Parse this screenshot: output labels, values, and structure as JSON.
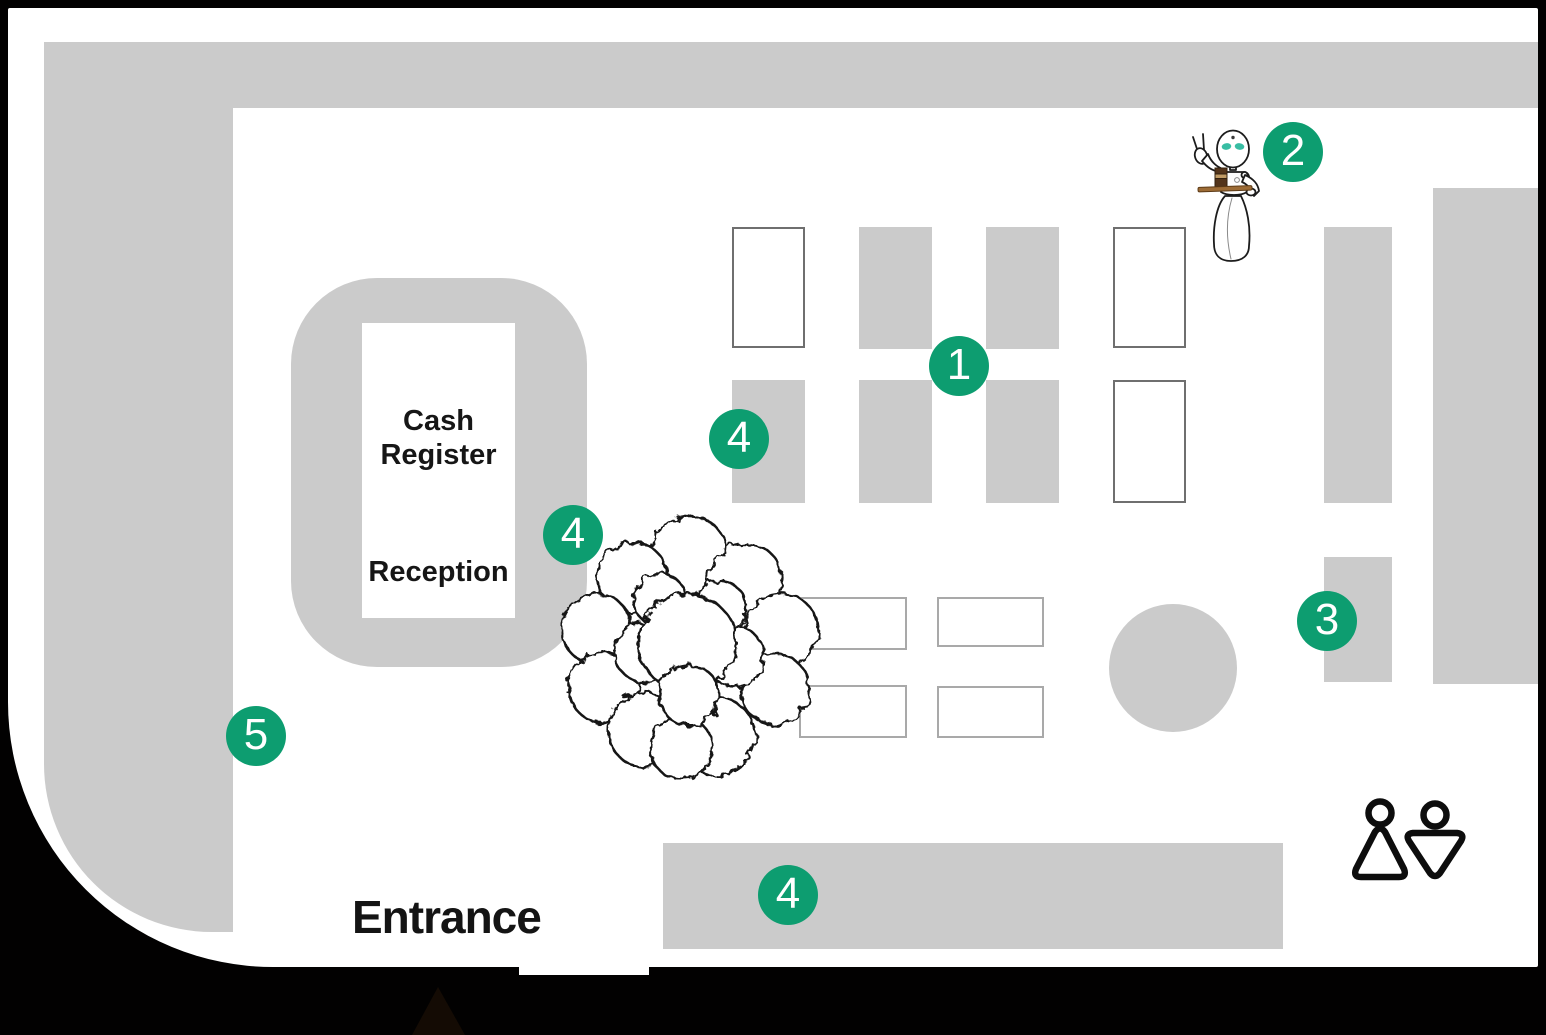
{
  "labels": {
    "cash_register": "Cash\nRegister",
    "reception": "Reception",
    "entrance": "Entrance"
  },
  "markers": {
    "m1": "1",
    "m2": "2",
    "m3": "3",
    "m4_dining": "4",
    "m4_register": "4",
    "m4_counter": "4",
    "m5": "5"
  },
  "icons": {
    "robot": "service-robot-icon",
    "tree": "tree-icon",
    "restroom": "restroom-icon"
  },
  "colors": {
    "accent_green": "#0d9d70",
    "wall_gray": "#cbcbcb",
    "floor_white": "#ffffff",
    "frame_black": "#000000",
    "table_outline_dark": "#6f6f6f",
    "table_outline_light": "#a9a9a9",
    "robot_eye_teal": "#38bda3",
    "tray_brown": "#9c6b35",
    "cup_dark_brown": "#4a2c14"
  }
}
